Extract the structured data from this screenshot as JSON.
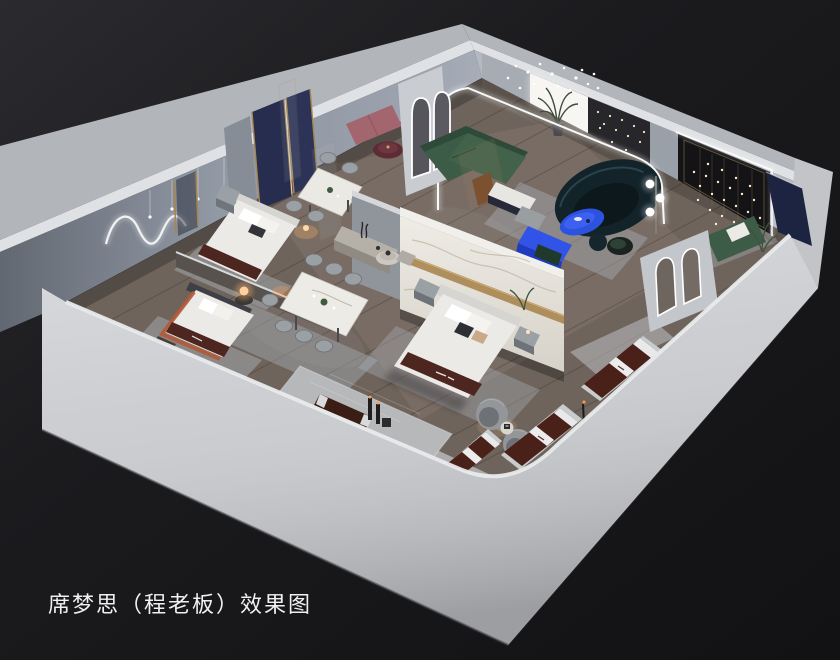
{
  "caption": {
    "text": "席梦思（程老板）效果图"
  },
  "scene": {
    "alt": "Isometric 3D cutaway render of a mattress showroom interior with bedroom, dining and lounge displays",
    "style": "dark studio background, light grey exterior walls, warm wood floor"
  },
  "palette": {
    "bg1": "#2b2b2f",
    "bg2": "#1b1b1e",
    "bg3": "#121214",
    "wallLight": "#c9cbcf",
    "wallOuter": "#b2b5b9",
    "wallTop": "#dfe1e4",
    "wallFace": "#98a0ac",
    "cornerBlock": "#c2c4c8",
    "floor": "#6e645c",
    "tile": "#b7b8ba",
    "rug": "#a7adb3",
    "marble": "#ece9e3",
    "gold": "#a8854f",
    "navy": "#262d4f",
    "navyDark": "#1d2442",
    "green": "#3d5c47",
    "greenDark": "#2f4a39",
    "teal": "#13232a",
    "blue": "#2e52e0",
    "blueDark": "#1f3cc0",
    "pink": "#a3656e",
    "wine": "#5c2b34",
    "mattress": "#4a2119",
    "mattressBench": "#3a1d15",
    "bedding": "#eceae6",
    "headboard": "#d7d5d1",
    "runner": "#4e2620",
    "chairGray": "#9aa0a4",
    "consoleBeige": "#b5b0a8",
    "accent": "#141417",
    "panelDark": "#27272b",
    "led": "#ffffff",
    "lampWarm": "#ffcf9d",
    "caption": "#f0f0f0"
  }
}
